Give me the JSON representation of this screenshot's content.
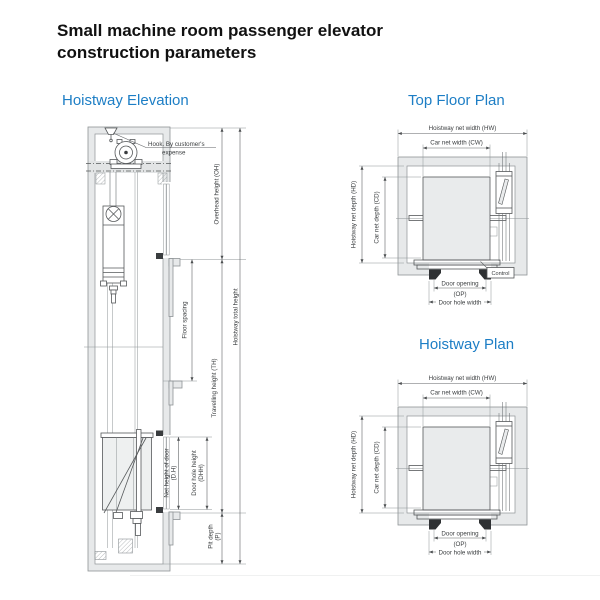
{
  "page": {
    "title": "Small machine room passenger elevator construction parameters",
    "accent_color": "#1d7ec5"
  },
  "elevation": {
    "heading": "Hoistway Elevation",
    "labels": {
      "hook_line1": "Hook. By customer's",
      "hook_line2": "expense",
      "overhead_height": "Overhead height (OH)",
      "floor_spacing": "Floor spacing",
      "travelling_height": "Travelling height (TH)",
      "hoistway_total_height": "Hoistway total height",
      "net_door_height_line1": "Net height of door",
      "net_door_height_line2": "(D.H)",
      "door_hole_height_line1": "Door hole height",
      "door_hole_height_line2": "(DHH)",
      "pit_depth_line1": "Pit depth",
      "pit_depth_line2": "(P)"
    }
  },
  "top_floor_plan": {
    "heading": "Top Floor Plan",
    "labels": {
      "hoistway_net_width": "Hoistway net width (HW)",
      "car_net_width": "Car net width (CW)",
      "hoistway_net_depth": "Hoistway net depth (HD)",
      "car_net_depth": "Car net depth (CD)",
      "door_opening_line1": "Door opening",
      "door_opening_line2": "(OP)",
      "door_hole_width": "Door hole width",
      "control": "Control"
    }
  },
  "hoistway_plan": {
    "heading": "Hoistway Plan",
    "labels": {
      "hoistway_net_width": "Hoistway net width (HW)",
      "car_net_width": "Car net width (CW)",
      "hoistway_net_depth": "Hoistway net depth (HD)",
      "car_net_depth": "Car net depth (CD)",
      "door_opening_line1": "Door opening",
      "door_opening_line2": "(OP)",
      "door_hole_width": "Door hole width"
    }
  }
}
